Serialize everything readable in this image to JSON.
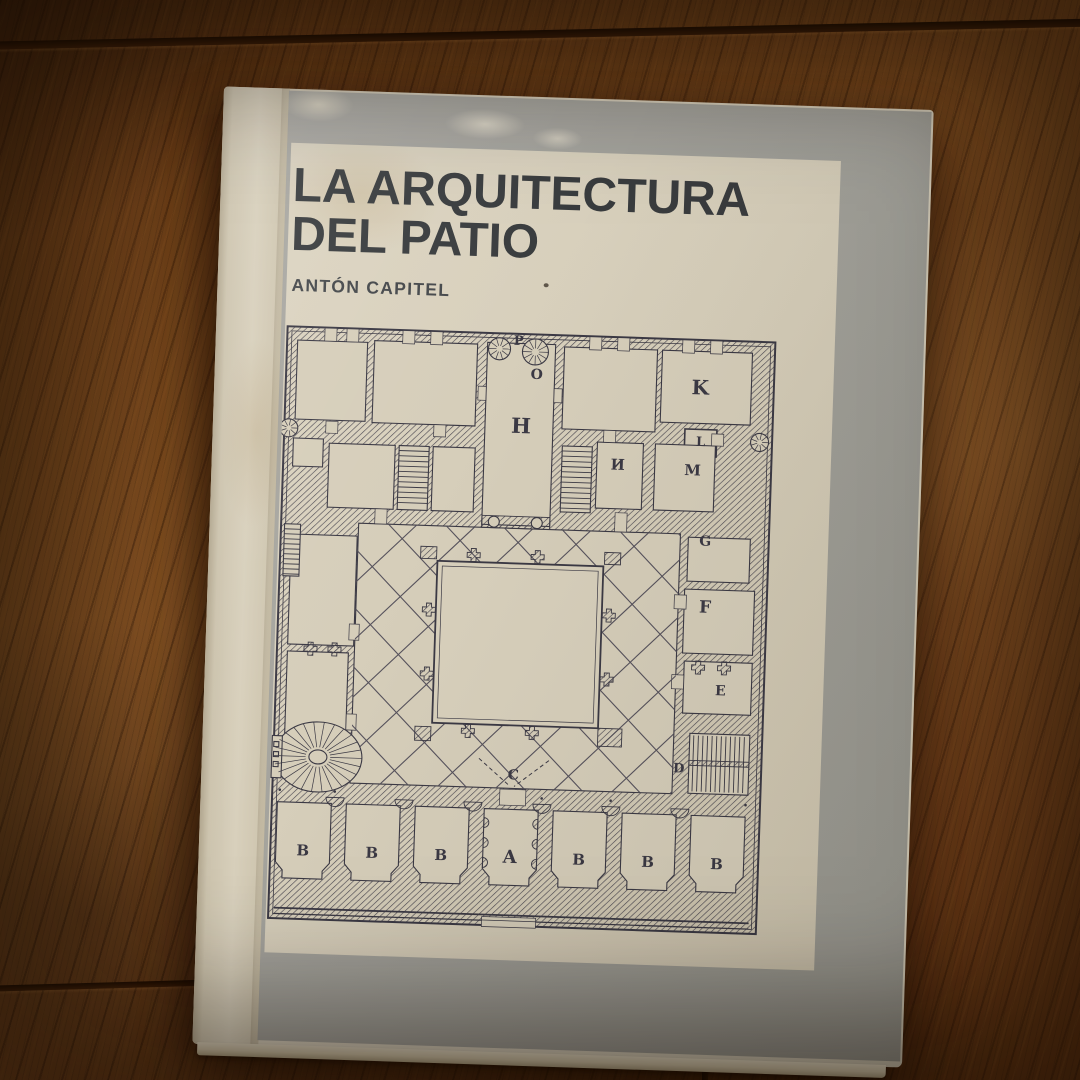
{
  "book": {
    "title_line1": "LA ARQUITECTURA",
    "title_line2": "DEL PATIO",
    "author": "ANTÓN CAPITEL"
  },
  "colors": {
    "cover_gray": "#a3a29b",
    "panel_cream": "#d6ceba",
    "plan_ink": "#3b3944",
    "title_ink": "#393c3e",
    "table_wood": "#7a4a1f"
  },
  "floor_plan": {
    "labels": [
      {
        "t": "P",
        "x": 234,
        "y": 10,
        "s": 13
      },
      {
        "t": "O",
        "x": 253,
        "y": 43,
        "s": 14
      },
      {
        "t": "H",
        "x": 239,
        "y": 94,
        "s": 21
      },
      {
        "t": "K",
        "x": 417,
        "y": 50,
        "s": 20
      },
      {
        "t": "L",
        "x": 419,
        "y": 105,
        "s": 13
      },
      {
        "t": "И",
        "x": 337,
        "y": 130,
        "s": 15
      },
      {
        "t": "M",
        "x": 412,
        "y": 133,
        "s": 15
      },
      {
        "t": "G",
        "x": 427,
        "y": 204,
        "s": 14
      },
      {
        "t": "F",
        "x": 429,
        "y": 270,
        "s": 17
      },
      {
        "t": "E",
        "x": 447,
        "y": 353,
        "s": 14
      },
      {
        "t": "D",
        "x": 408,
        "y": 432,
        "s": 13
      },
      {
        "t": "C",
        "x": 243,
        "y": 444,
        "s": 14
      },
      {
        "t": "A",
        "x": 242,
        "y": 526,
        "s": 18
      },
      {
        "t": "B",
        "x": 35,
        "y": 526,
        "s": 15
      },
      {
        "t": "B",
        "x": 104,
        "y": 526,
        "s": 15
      },
      {
        "t": "B",
        "x": 173,
        "y": 526,
        "s": 15
      },
      {
        "t": "B",
        "x": 311,
        "y": 526,
        "s": 15
      },
      {
        "t": "B",
        "x": 380,
        "y": 526,
        "s": 15
      },
      {
        "t": "B",
        "x": 449,
        "y": 526,
        "s": 15
      }
    ]
  }
}
